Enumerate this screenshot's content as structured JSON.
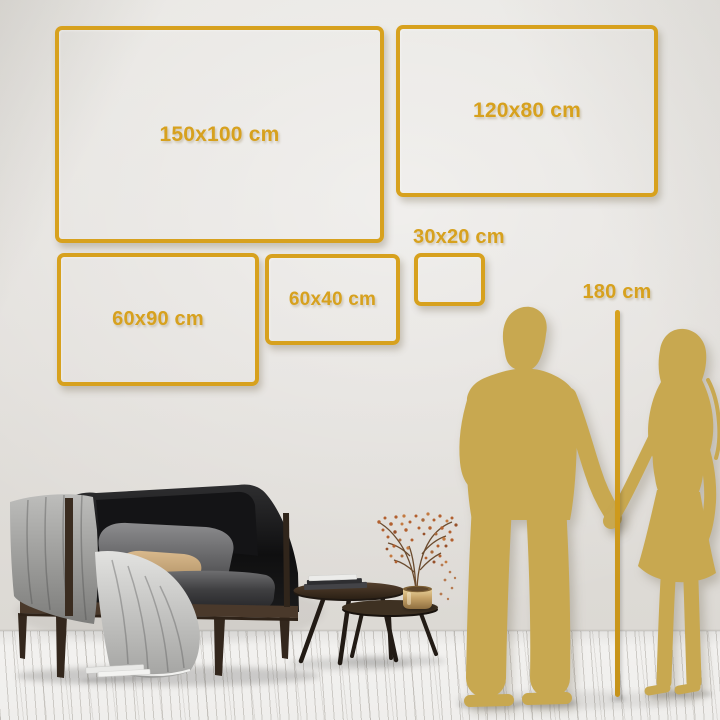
{
  "palette": {
    "accent_gold": "#d7a11e",
    "silhouette_gold": "#c8a850",
    "wall": "#e2dfdb",
    "floor": "#f1f0ee"
  },
  "sizes": [
    {
      "label": "150x100 cm"
    },
    {
      "label": "120x80 cm"
    },
    {
      "label": "60x90 cm"
    },
    {
      "label": "60x40 cm"
    },
    {
      "label": "30x20 cm"
    }
  ],
  "height_reference": {
    "label": "180 cm"
  }
}
